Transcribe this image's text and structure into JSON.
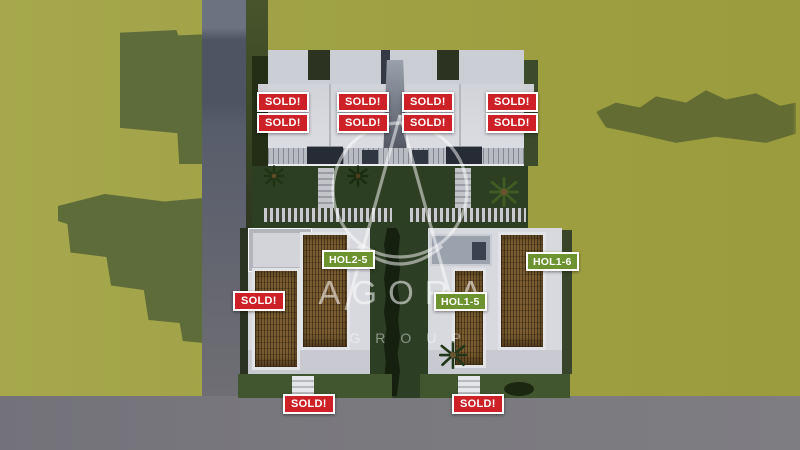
{
  "scene": {
    "type": "aerial-3d-architectural-render",
    "watermark": {
      "brand": "AGORA",
      "division": "GROUP",
      "logo": "agora-monogram-icon"
    },
    "labels": {
      "sold": "SOLD!"
    },
    "units": [
      {
        "id": "hol2-5",
        "label": "HOL2-5",
        "badge_color": "#6d9230"
      },
      {
        "id": "hol1-6",
        "label": "HOL1-6",
        "badge_color": "#6d9230"
      },
      {
        "id": "hol1-5",
        "label": "HOL1-5",
        "badge_color": "#6d9230"
      }
    ],
    "sold_badge_count": 11,
    "colors": {
      "sold_badge": "#ce2127",
      "unit_badge": "#6d9230",
      "grass": "#a2a348",
      "tree_shadow": "#5e6c39",
      "road": "#7a797e",
      "building_white": "#d8d9de",
      "wood_roof": "#7b5d31",
      "garden": "#2d3f23"
    }
  }
}
